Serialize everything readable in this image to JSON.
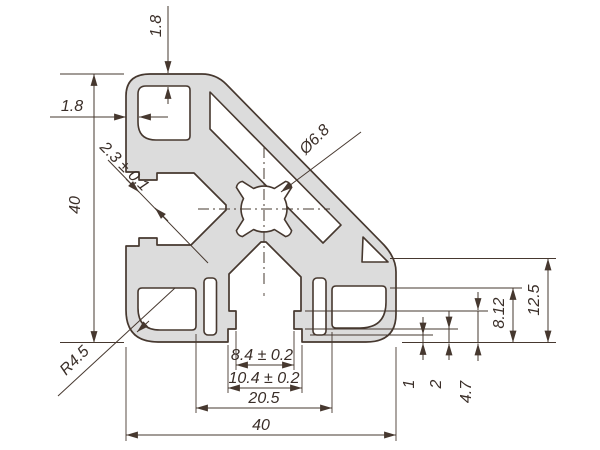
{
  "drawing": {
    "type": "aluminium-extrusion-profile-cross-section",
    "dims": {
      "top_wall": "1.8",
      "left_wall": "1.8",
      "height": "40",
      "width": "40",
      "lip_gap": "2.3 ± 0.1",
      "bore": "Ø6.8",
      "corner_radius": "R4.5",
      "slot_lip_width": "8.4 ± 0.2",
      "slot_mouth_width": "10.4 ± 0.2",
      "core_width": "20.5",
      "right_face_height": "12.5",
      "cavity_height": "8.12",
      "lip_depth": "4.7",
      "web_wall": "2",
      "thin_wall": "1"
    },
    "colors": {
      "profile_fill": "#dcdcdc",
      "line": "#46382f",
      "background": "#ffffff"
    }
  }
}
